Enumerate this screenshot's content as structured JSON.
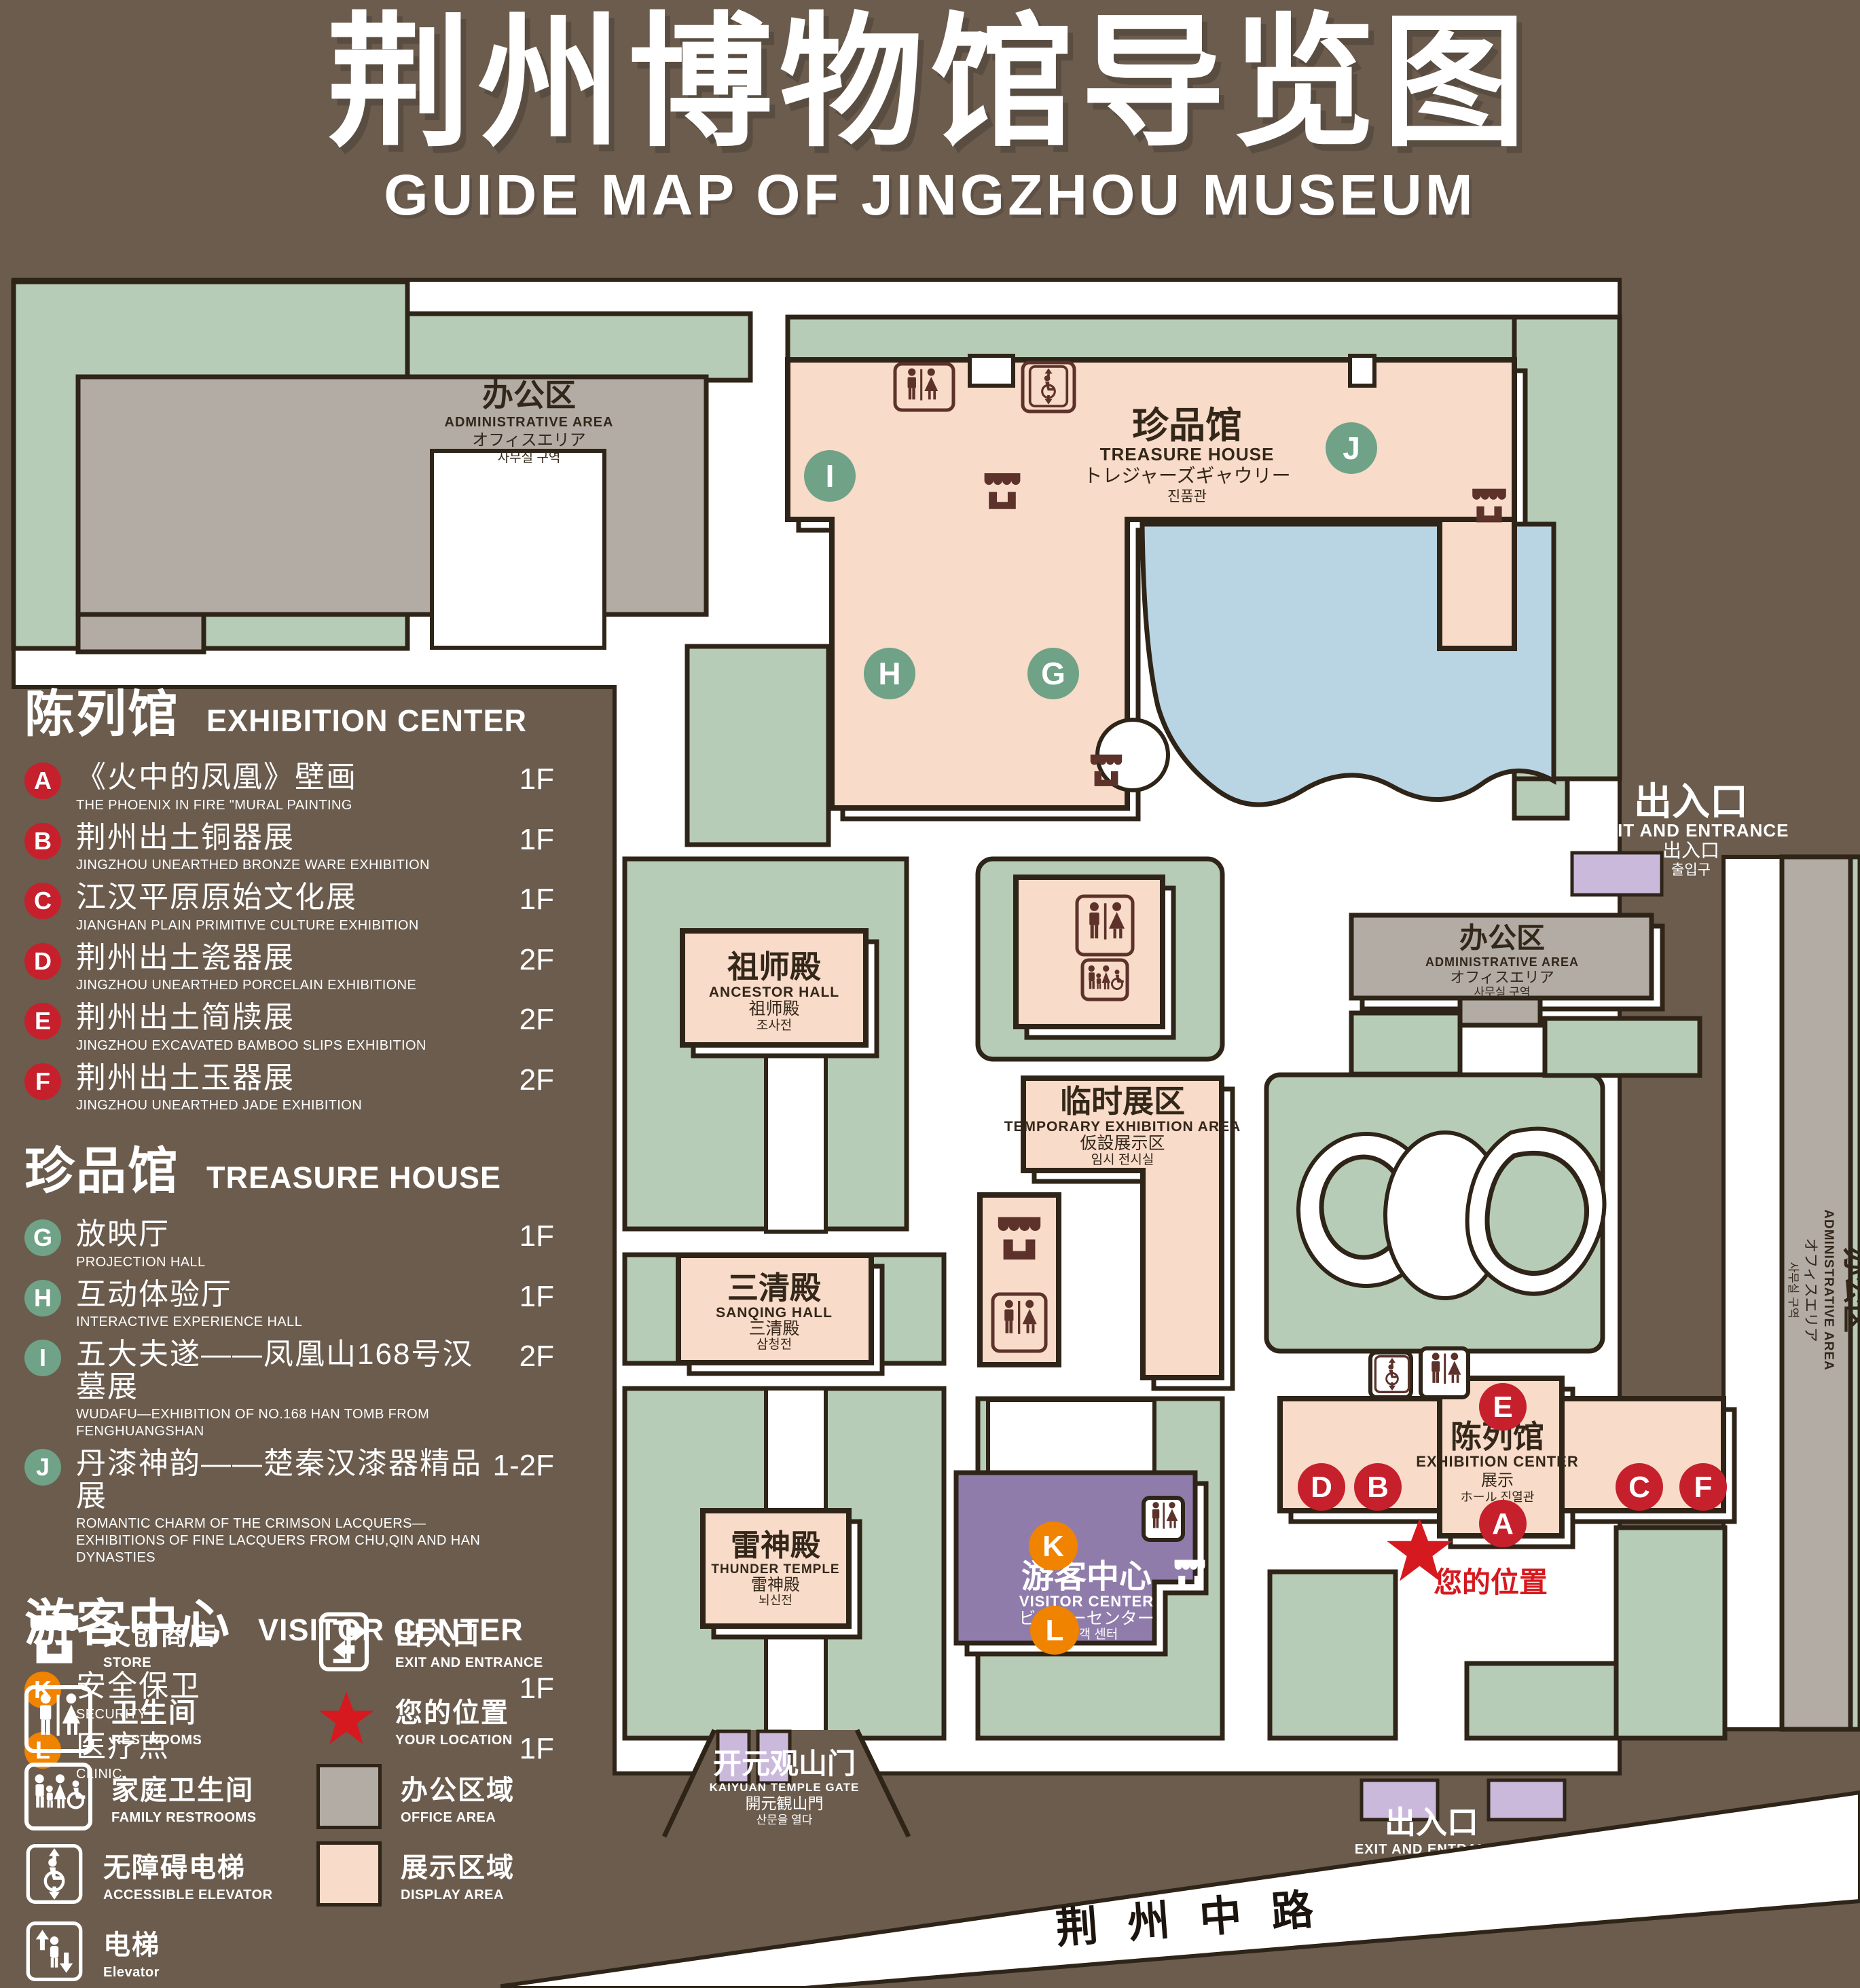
{
  "title": {
    "zh": "荆州博物馆导览图",
    "en": "GUIDE MAP OF JINGZHOU MUSEUM"
  },
  "colors": {
    "background": "#6b5c4e",
    "green_area": "#b7ccb6",
    "display_area": "#f8dbc8",
    "office_area": "#b3aca5",
    "visitor_center": "#8f7cab",
    "pond": "#b9d4e2",
    "gate_accent": "#cbb9dc",
    "marker_red": "#c5202c",
    "marker_green": "#6fa287",
    "marker_orange": "#f08300",
    "location_red": "#d6191f",
    "outline": "#2f2418",
    "icon_dark": "#5c322a"
  },
  "legend": {
    "sections": [
      {
        "zh": "陈列馆",
        "en": "EXHIBITION CENTER",
        "items": [
          {
            "code": "A",
            "zh": "《火中的凤凰》壁画",
            "en": "THE PHOENIX IN FIRE \"MURAL PAINTING",
            "floor": "1F"
          },
          {
            "code": "B",
            "zh": "荆州出土铜器展",
            "en": "JINGZHOU UNEARTHED BRONZE WARE EXHIBITION",
            "floor": "1F"
          },
          {
            "code": "C",
            "zh": "江汉平原原始文化展",
            "en": "JIANGHAN PLAIN PRIMITIVE CULTURE EXHIBITION",
            "floor": "1F"
          },
          {
            "code": "D",
            "zh": "荆州出土瓷器展",
            "en": "JINGZHOU UNEARTHED PORCELAIN EXHIBITIONE",
            "floor": "2F"
          },
          {
            "code": "E",
            "zh": "荆州出土简牍展",
            "en": "JINGZHOU EXCAVATED BAMBOO SLIPS EXHIBITION",
            "floor": "2F"
          },
          {
            "code": "F",
            "zh": "荆州出土玉器展",
            "en": "JINGZHOU UNEARTHED JADE EXHIBITION",
            "floor": "2F"
          }
        ]
      },
      {
        "zh": "珍品馆",
        "en": "TREASURE HOUSE",
        "items": [
          {
            "code": "G",
            "zh": "放映厅",
            "en": "PROJECTION HALL",
            "floor": "1F"
          },
          {
            "code": "H",
            "zh": "互动体验厅",
            "en": "INTERACTIVE EXPERIENCE HALL",
            "floor": "1F"
          },
          {
            "code": "I",
            "zh": "五大夫遂——凤凰山168号汉墓展",
            "en": "WUDAFU—EXHIBITION OF NO.168 HAN TOMB FROM FENGHUANGSHAN",
            "floor": "2F"
          },
          {
            "code": "J",
            "zh": "丹漆神韵——楚秦汉漆器精品展",
            "en": "ROMANTIC CHARM OF THE CRIMSON LACQUERS—EXHIBITIONS OF FINE LACQUERS FROM CHU,QIN AND HAN DYNASTIES",
            "floor": "1-2F"
          }
        ]
      },
      {
        "zh": "游客中心",
        "en": "VISITOR CENTER",
        "items": [
          {
            "code": "K",
            "zh": "安全保卫",
            "en": "SECURITY",
            "floor": "1F"
          },
          {
            "code": "L",
            "zh": "医疗点",
            "en": "CLINIC",
            "floor": "1F"
          }
        ]
      }
    ],
    "symbols": [
      {
        "icon": "store-icon",
        "zh": "文创商店",
        "en": "STORE"
      },
      {
        "icon": "exit-icon",
        "zh": "出入口",
        "en": "EXIT AND ENTRANCE"
      },
      {
        "icon": "restroom-icon",
        "zh": "卫生间",
        "en": "RESTROOMS"
      },
      {
        "icon": "location-icon",
        "zh": "您的位置",
        "en": "YOUR LOCATION"
      },
      {
        "icon": "family-restroom-icon",
        "zh": "家庭卫生间",
        "en": "FAMILY RESTROOMS"
      },
      {
        "icon": "office-swatch",
        "zh": "办公区域",
        "en": "OFFICE AREA"
      },
      {
        "icon": "accessible-elevator-icon",
        "zh": "无障碍电梯",
        "en": "ACCESSIBLE ELEVATOR"
      },
      {
        "icon": "display-swatch",
        "zh": "展示区域",
        "en": "DISPLAY AREA"
      },
      {
        "icon": "elevator-icon",
        "zh": "电梯",
        "en": "Elevator"
      }
    ]
  },
  "map": {
    "admin": {
      "zh": "办公区",
      "en": "ADMINISTRATIVE AREA",
      "ja": "オフィスエリア",
      "ko": "사무실 구역"
    },
    "treasure": {
      "zh": "珍品馆",
      "en": "TREASURE HOUSE",
      "ja": "トレジャーズギャウリー",
      "ko": "진품관"
    },
    "ancestor": {
      "zh": "祖师殿",
      "en": "ANCESTOR HALL",
      "ja": "祖师殿",
      "ko": "조사전"
    },
    "temporary": {
      "zh": "临时展区",
      "en": "TEMPORARY EXHIBITION AREA",
      "ja": "仮設展示区",
      "ko": "임시 전시실"
    },
    "sanqing": {
      "zh": "三清殿",
      "en": "SANQING HALL",
      "ja": "三清殿",
      "ko": "삼청전"
    },
    "thunder": {
      "zh": "雷神殿",
      "en": "THUNDER TEMPLE",
      "ja": "雷神殿",
      "ko": "뇌신전"
    },
    "visitor": {
      "zh": "游客中心",
      "en": "VISITOR CENTER",
      "ja": "ビジターセンター",
      "ko": "관광객 센터"
    },
    "exhibition": {
      "zh": "陈列馆",
      "en": "EXHIBITION CENTER",
      "ja": "展示",
      "ko": "ホール 진열관"
    },
    "entrance": {
      "zh": "出入口",
      "en": "EXIT AND ENTRANCE",
      "ja": "出入口",
      "ko": "출입구"
    },
    "gate": {
      "zh": "开元观山门",
      "en": "KAIYUAN TEMPLE GATE",
      "ja": "開元観山門",
      "ko": "산문을 열다"
    },
    "road": "荆州中路",
    "your_location": "您的位置",
    "m": {
      "a": "A",
      "b": "B",
      "c": "C",
      "d": "D",
      "e": "E",
      "f": "F",
      "g": "G",
      "h": "H",
      "i": "I",
      "j": "J",
      "k": "K",
      "l": "L"
    }
  }
}
